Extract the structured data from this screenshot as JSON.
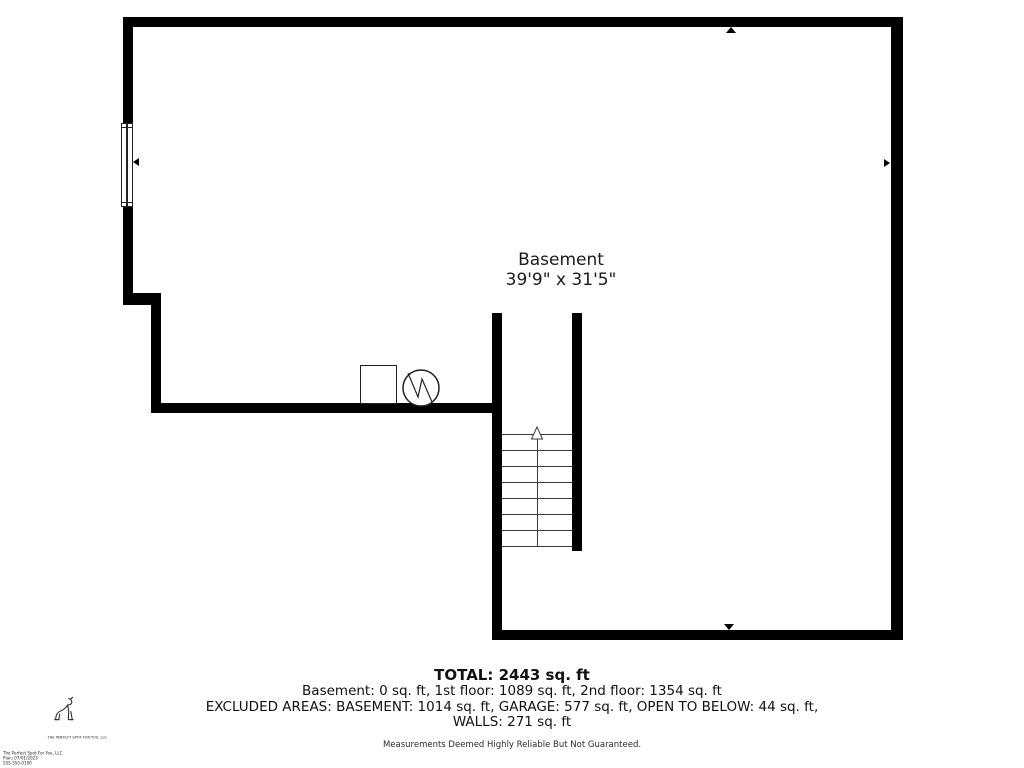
{
  "colors": {
    "wall": "#000000",
    "text": "#1a1a1a",
    "stair_line": "#3a3a3a"
  },
  "room": {
    "name": "Basement",
    "dimensions": "39'9\" x 31'5\""
  },
  "stairs": {
    "direction": "up",
    "tread_count": 8,
    "tread_spacing_px": 16
  },
  "symbols": {
    "square_utility": "utility-box",
    "circle_utility": "water-heater"
  },
  "summary": {
    "total": "TOTAL: 2443 sq. ft",
    "floors": "Basement: 0 sq. ft, 1st floor: 1089 sq. ft, 2nd floor: 1354 sq. ft",
    "excluded": "EXCLUDED AREAS: BASEMENT: 1014 sq. ft, GARAGE: 577 sq. ft, OPEN TO BELOW: 44 sq. ft,",
    "walls": "WALLS: 271 sq. ft",
    "disclaimer": "Measurements Deemed Highly Reliable But Not Guaranteed."
  },
  "branding": {
    "company": "THE PERFECT SPOT FOR YOU, LLC",
    "credits": [
      "The Perfect Spot For You, LLC",
      "Plan: 07/01/2023",
      "555-555-0100"
    ]
  }
}
